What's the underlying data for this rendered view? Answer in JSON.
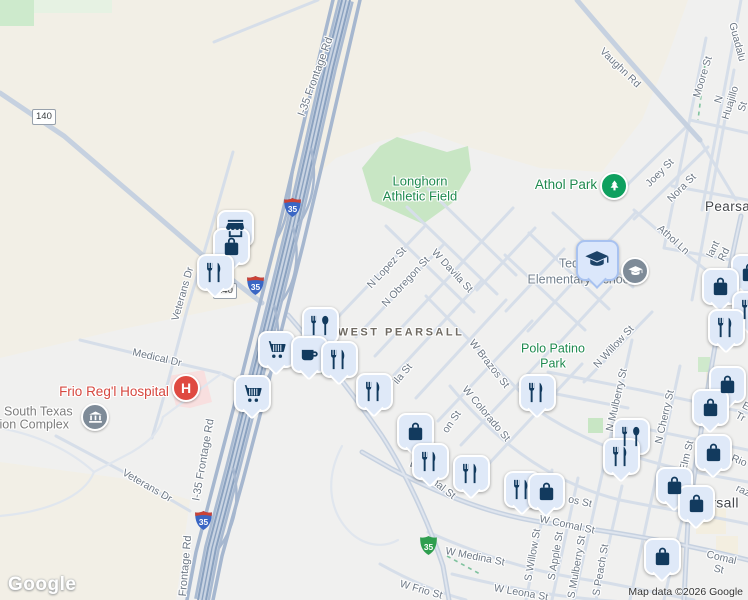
{
  "watermark": {
    "text": "Google"
  },
  "attribution": {
    "text": "Map data ©2026 Google"
  },
  "colors": {
    "land": "#f2efe6",
    "urban": "#f0f0ef",
    "park_fill": "#c8e6c4",
    "road": "#d6dee9",
    "highway": "#a9bad1",
    "highway_line": "#8ba2c0",
    "marker_bg": "#dfe9f8",
    "marker_glyph": "#123a5e",
    "park_text": "#1f8a4f",
    "tree_green": "#0fa05f",
    "hospital_red": "#df4a41",
    "interstate_blue": "#3a66c4",
    "interstate_red": "#cb4335",
    "business_green": "#2f9e4f"
  },
  "labels": [
    {
      "t": "I-35 Frontage Rd",
      "x": 316,
      "y": 77,
      "r": -70,
      "s": 11
    },
    {
      "t": "Vaughn Rd",
      "x": 620,
      "y": 68,
      "r": 44
    },
    {
      "t": "Guadalu",
      "x": 737,
      "y": 42,
      "r": 75
    },
    {
      "t": "Moore St",
      "x": 703,
      "y": 77,
      "r": -73
    },
    {
      "t": "N Huajillo St",
      "x": 731,
      "y": 103,
      "r": -73
    },
    {
      "t": "Joey St",
      "x": 660,
      "y": 173,
      "r": -45
    },
    {
      "t": "Nora St",
      "x": 682,
      "y": 188,
      "r": -45
    },
    {
      "t": "Athol Ln",
      "x": 673,
      "y": 240,
      "r": 42
    },
    {
      "t": "lant Rd",
      "x": 719,
      "y": 252,
      "r": -64
    },
    {
      "t": "N Lopez St",
      "x": 387,
      "y": 268,
      "r": -47
    },
    {
      "t": "N Obregon St",
      "x": 406,
      "y": 282,
      "r": -47
    },
    {
      "t": "W Davila St",
      "x": 452,
      "y": 271,
      "r": 47
    },
    {
      "t": "Veterans Dr",
      "x": 183,
      "y": 294,
      "r": -74
    },
    {
      "t": "Medical Dr",
      "x": 157,
      "y": 358,
      "r": 13
    },
    {
      "t": "N Willow St",
      "x": 614,
      "y": 347,
      "r": -47
    },
    {
      "t": "W Brazos St",
      "x": 489,
      "y": 364,
      "r": 52
    },
    {
      "t": "N Mulberry St",
      "x": 617,
      "y": 400,
      "r": -77
    },
    {
      "t": "N Cherry St",
      "x": 665,
      "y": 417,
      "r": -77
    },
    {
      "t": "W Colorado St",
      "x": 486,
      "y": 414,
      "r": 50
    },
    {
      "t": "ila St",
      "x": 403,
      "y": 374,
      "r": -50
    },
    {
      "t": "on St",
      "x": 452,
      "y": 422,
      "r": -55
    },
    {
      "t": "W Comal St",
      "x": 432,
      "y": 480,
      "r": 38
    },
    {
      "t": "W Comal St",
      "x": 567,
      "y": 525,
      "r": 12
    },
    {
      "t": "os St",
      "x": 580,
      "y": 502,
      "r": 12
    },
    {
      "t": "S Willow St",
      "x": 533,
      "y": 555,
      "r": -80
    },
    {
      "t": "S Apple St",
      "x": 556,
      "y": 556,
      "r": -80
    },
    {
      "t": "S Mulberry St",
      "x": 577,
      "y": 567,
      "r": -80
    },
    {
      "t": "S Peach St",
      "x": 601,
      "y": 570,
      "r": -80
    },
    {
      "t": "W Medina St",
      "x": 475,
      "y": 557,
      "r": 11
    },
    {
      "t": "W Frio St",
      "x": 421,
      "y": 590,
      "r": 16
    },
    {
      "t": "W Leona St",
      "x": 521,
      "y": 593,
      "r": 10
    },
    {
      "t": "Comal St",
      "x": 720,
      "y": 564,
      "r": 13
    },
    {
      "t": "Elm St",
      "x": 687,
      "y": 456,
      "r": -76
    },
    {
      "t": "E Tr",
      "x": 743,
      "y": 412,
      "r": 28
    },
    {
      "t": "Rio",
      "x": 739,
      "y": 461,
      "r": 22
    },
    {
      "t": "raz",
      "x": 743,
      "y": 491,
      "r": 25
    },
    {
      "t": "I-35 Frontage Rd",
      "x": 204,
      "y": 460,
      "r": -80,
      "s": 11
    },
    {
      "t": "Frontage Rd",
      "x": 186,
      "y": 566,
      "r": -85,
      "s": 11
    },
    {
      "t": "Veterans Dr",
      "x": 147,
      "y": 486,
      "r": 30
    },
    {
      "t": "Longhorn\nAthletic Field",
      "x": 420,
      "y": 189,
      "type": "park",
      "s": 13,
      "name": "label-longhorn-athletic-field"
    },
    {
      "t": "Athol Park",
      "x": 566,
      "y": 185,
      "type": "park",
      "s": 13.5,
      "name": "label-athol-park"
    },
    {
      "t": "Polo Patino\nPark",
      "x": 553,
      "y": 356,
      "type": "park",
      "s": 12.5,
      "name": "label-polo-patino-park"
    },
    {
      "t": "Ted Flores",
      "x": 588,
      "y": 264,
      "type": "school",
      "s": 12.5,
      "name": "label-school-line1"
    },
    {
      "t": "Elementary School",
      "x": 580,
      "y": 280,
      "type": "school",
      "s": 12.5,
      "name": "label-school-line2"
    },
    {
      "t": "South Texas",
      "x": 4,
      "y": 412,
      "type": "poi",
      "s": 12.5,
      "anchor": "left",
      "name": "label-complex-line1"
    },
    {
      "t": "tion Complex",
      "x": -4,
      "y": 425,
      "type": "poi",
      "s": 12.5,
      "anchor": "left",
      "name": "label-complex-line2"
    },
    {
      "t": "Frio Reg'l Hospital",
      "x": 114,
      "y": 392,
      "type": "hospital",
      "s": 13.5,
      "name": "label-frio-regional-hospital"
    },
    {
      "t": "Pearsall",
      "x": 705,
      "y": 207,
      "type": "city",
      "s": 13.5,
      "anchor": "left",
      "name": "label-city-pearsall-north"
    },
    {
      "t": "Pearsall",
      "x": 712,
      "y": 503,
      "type": "city",
      "s": 14,
      "name": "label-city-pearsall-east"
    },
    {
      "t": "WEST PEARSALL",
      "x": 401,
      "y": 333,
      "type": "hood",
      "s": 11,
      "ls": 2.5,
      "name": "label-west-pearsall"
    }
  ],
  "shields": [
    {
      "type": "rect",
      "label": "140",
      "x": 47,
      "y": 117
    },
    {
      "type": "rect",
      "label": "140",
      "x": 228,
      "y": 291
    },
    {
      "type": "interstate",
      "label": "35",
      "x": 292,
      "y": 207
    },
    {
      "type": "interstate",
      "label": "35",
      "x": 255,
      "y": 285
    },
    {
      "type": "interstate",
      "label": "35",
      "x": 203,
      "y": 520
    },
    {
      "type": "business",
      "label": "35",
      "x": 428,
      "y": 545
    }
  ],
  "poi": [
    {
      "kind": "school-marker",
      "icon": "cap",
      "x": 597,
      "y": 260
    },
    {
      "kind": "circle",
      "icon": "cap",
      "color": "gray",
      "x": 635,
      "y": 271,
      "name": "school-poi-marker"
    },
    {
      "kind": "circle",
      "icon": "tree",
      "color": "green",
      "x": 614,
      "y": 186,
      "name": "park-marker"
    },
    {
      "kind": "circle",
      "icon": "bank",
      "color": "gray",
      "x": 95,
      "y": 417,
      "name": "civic-marker"
    },
    {
      "kind": "circle",
      "icon": "hospital",
      "color": "red",
      "x": 186,
      "y": 388,
      "label": "H",
      "name": "hospital-marker"
    }
  ],
  "markers": [
    {
      "icon": "store",
      "x": 235,
      "y": 228
    },
    {
      "icon": "bag",
      "x": 231,
      "y": 246
    },
    {
      "icon": "fork-knife",
      "x": 215,
      "y": 272
    },
    {
      "icon": "fork-spoon",
      "x": 320,
      "y": 325
    },
    {
      "icon": "cart",
      "x": 276,
      "y": 349
    },
    {
      "icon": "cup",
      "x": 309,
      "y": 354
    },
    {
      "icon": "fork-knife",
      "x": 339,
      "y": 359
    },
    {
      "icon": "fork-knife",
      "x": 374,
      "y": 391
    },
    {
      "icon": "cart",
      "x": 252,
      "y": 393
    },
    {
      "icon": "bag",
      "x": 415,
      "y": 431
    },
    {
      "icon": "fork-knife",
      "x": 537,
      "y": 392
    },
    {
      "icon": "fork-knife",
      "x": 430,
      "y": 461
    },
    {
      "icon": "fork-knife",
      "x": 471,
      "y": 473
    },
    {
      "icon": "fork-knife",
      "x": 522,
      "y": 489
    },
    {
      "icon": "bag",
      "x": 546,
      "y": 491
    },
    {
      "icon": "fork-spoon",
      "x": 631,
      "y": 436
    },
    {
      "icon": "fork-knife",
      "x": 621,
      "y": 456
    },
    {
      "icon": "bag",
      "x": 749,
      "y": 272
    },
    {
      "icon": "bag",
      "x": 720,
      "y": 286
    },
    {
      "icon": "fork-knife",
      "x": 750,
      "y": 309
    },
    {
      "icon": "fork-knife",
      "x": 726,
      "y": 327
    },
    {
      "icon": "bag",
      "x": 727,
      "y": 384
    },
    {
      "icon": "bag",
      "x": 710,
      "y": 407
    },
    {
      "icon": "bag",
      "x": 713,
      "y": 452
    },
    {
      "icon": "bag",
      "x": 674,
      "y": 485
    },
    {
      "icon": "bag",
      "x": 696,
      "y": 503
    },
    {
      "icon": "bag",
      "x": 662,
      "y": 556
    }
  ]
}
